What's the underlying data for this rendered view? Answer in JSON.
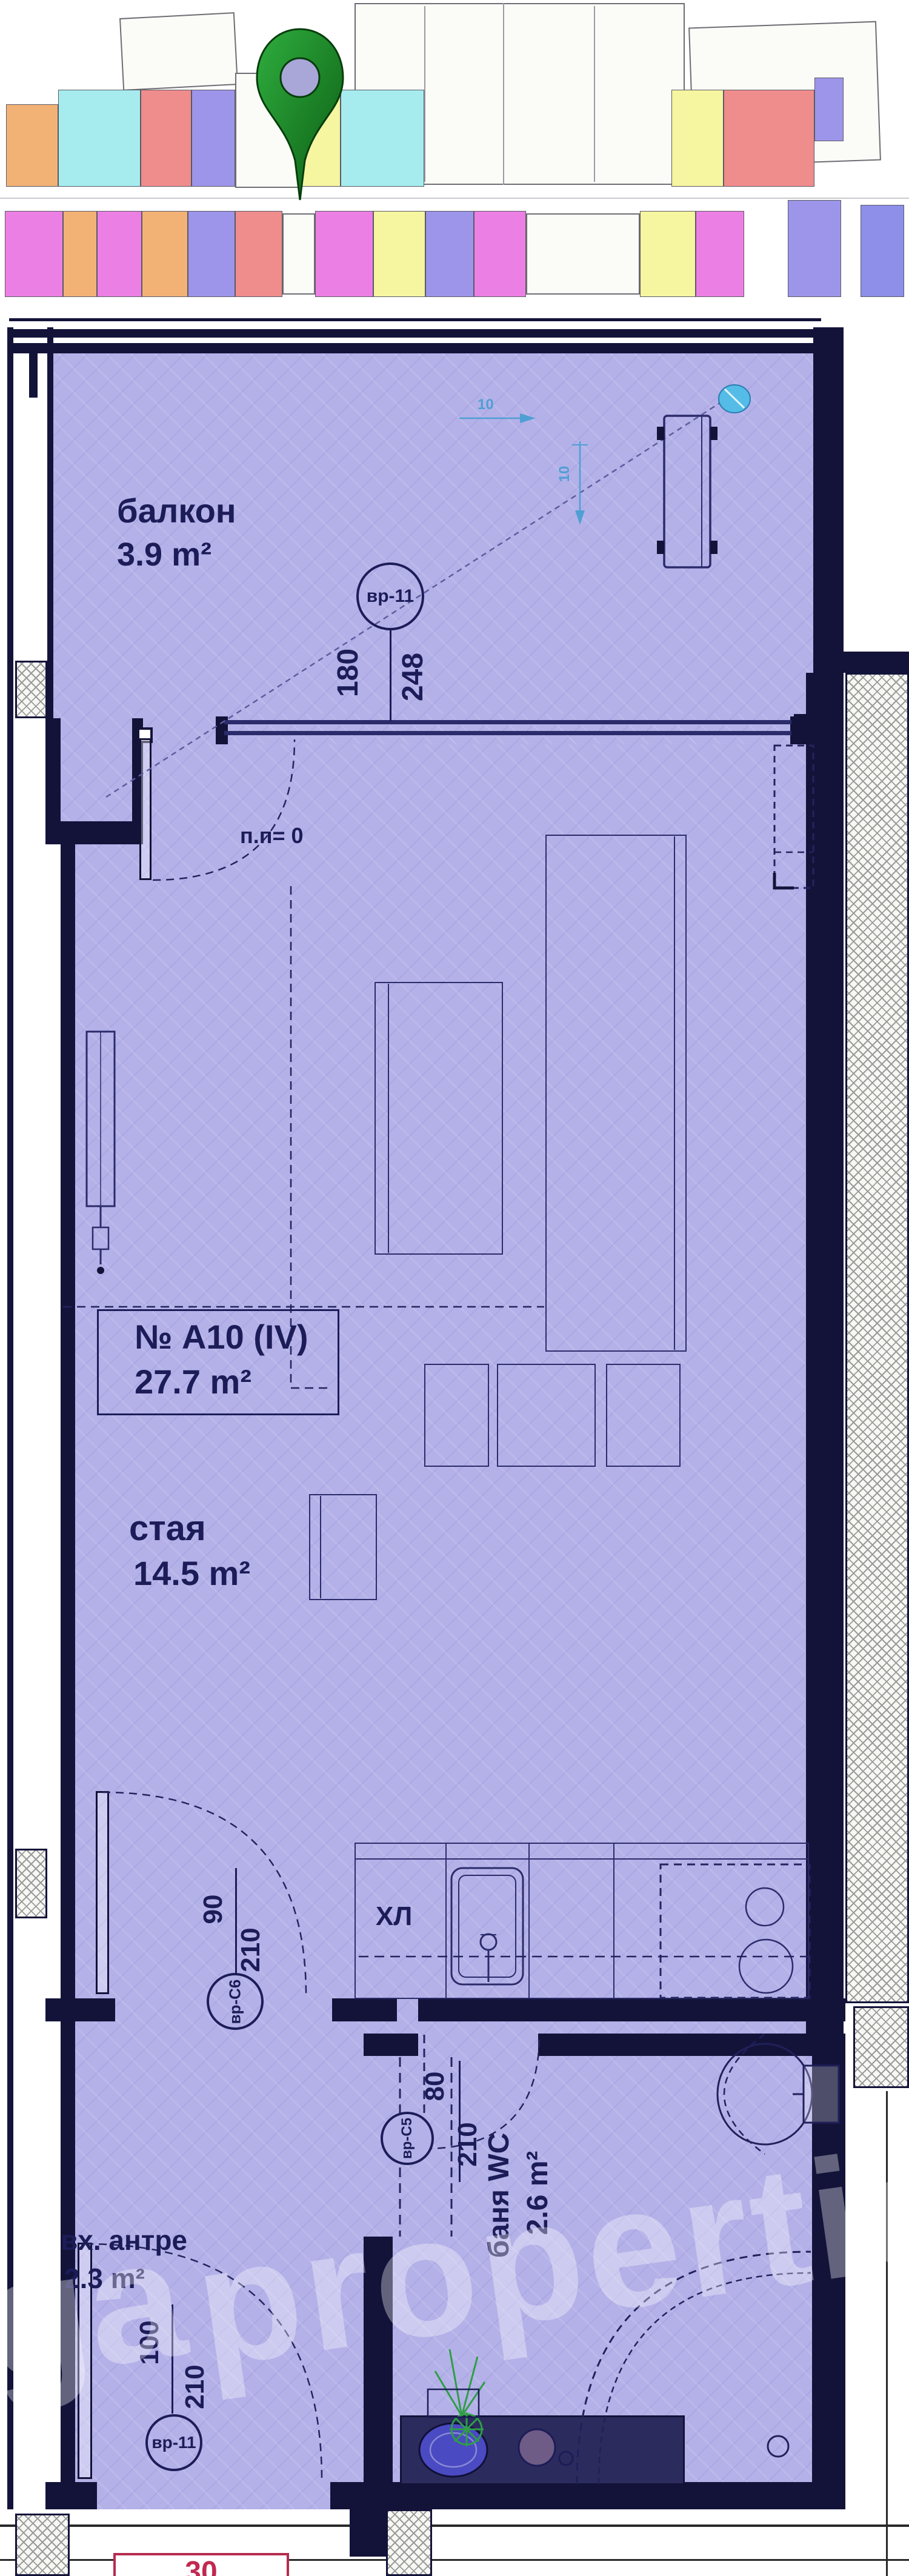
{
  "colors": {
    "floor": "#b4b1e8",
    "wall": "#13133a",
    "linework": "#2b2b6b",
    "slope_annotation": "#4f9fd4",
    "unit_badge_red": "#c22850",
    "pin_green": "#1e8c1e",
    "minimap_orange": "#f2b276",
    "minimap_cyan": "#a6ecee",
    "minimap_salmon": "#ef8c8c",
    "minimap_purple": "#9d95e9",
    "minimap_yellow": "#f6f5a0",
    "minimap_magenta": "#ec7fe3"
  },
  "plan": {
    "apartment": {
      "number": "№ А10 (IV)",
      "area": "27.7 m²"
    },
    "balcony": {
      "label": "балкон",
      "area": "3.9 m²"
    },
    "room": {
      "label": "стая",
      "area": "14.5 m²"
    },
    "entry": {
      "label": "вх. антре",
      "area": "2.3 m²"
    },
    "bath": {
      "label": "баня WC",
      "area": "2.6 m²"
    },
    "kitchen": {
      "fridge": "ХЛ"
    },
    "level_note": "п.п= 0",
    "unit": "30",
    "slope": "10",
    "tags": {
      "window": "вр-11",
      "room_door": "вр-С6",
      "bath_door": "вр-С5",
      "entry_door": "вр-11"
    },
    "dims": {
      "window": {
        "w": "180",
        "h": "248"
      },
      "room_door": {
        "w": "90",
        "h": "210"
      },
      "bath_door": {
        "w": "80",
        "h": "210"
      },
      "entry_door": {
        "w": "100",
        "h": "210"
      }
    }
  },
  "watermark": {
    "a": "ga",
    "b": "properties"
  }
}
